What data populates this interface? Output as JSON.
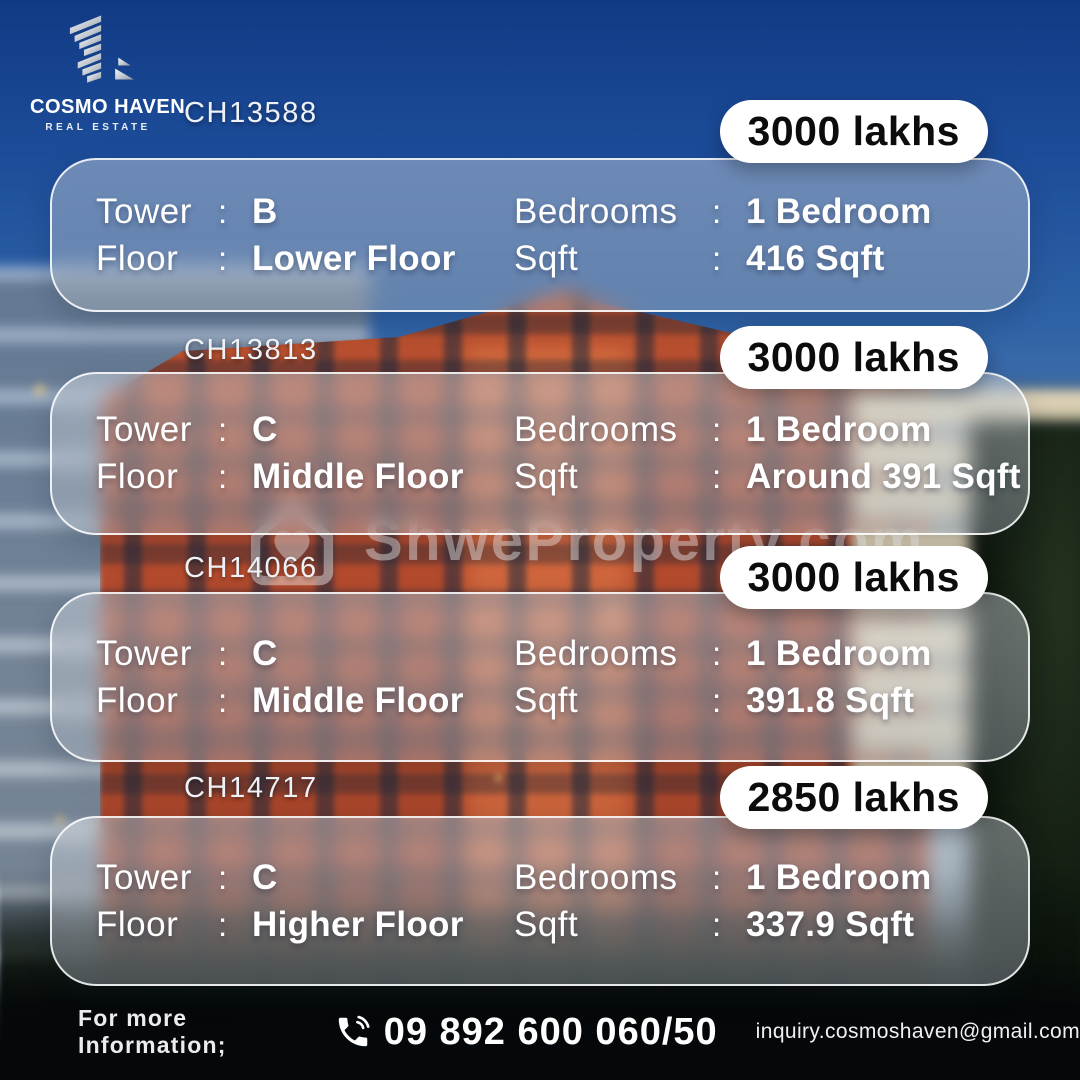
{
  "brand": {
    "name": "COSMO HAVEN",
    "tagline": "REAL ESTATE",
    "logo_icon": "building-stripes-icon"
  },
  "labels": {
    "tower": "Tower",
    "floor": "Floor",
    "bedrooms": "Bedrooms",
    "sqft": "Sqft",
    "colon": ":"
  },
  "listings": [
    {
      "code": "CH13588",
      "price": "3000 lakhs",
      "tower": "B",
      "floor": "Lower Floor",
      "bedrooms": "1 Bedroom",
      "sqft": "416 Sqft"
    },
    {
      "code": "CH13813",
      "price": "3000 lakhs",
      "tower": "C",
      "floor": "Middle Floor",
      "bedrooms": "1 Bedroom",
      "sqft": "Around 391 Sqft"
    },
    {
      "code": "CH14066",
      "price": "3000 lakhs",
      "tower": "C",
      "floor": "Middle Floor",
      "bedrooms": "1 Bedroom",
      "sqft": "391.8 Sqft"
    },
    {
      "code": "CH14717",
      "price": "2850 lakhs",
      "tower": "C",
      "floor": "Higher Floor",
      "bedrooms": "1 Bedroom",
      "sqft": "337.9 Sqft"
    }
  ],
  "watermark": {
    "text": "ShweProperty.com",
    "icon": "house-heart-icon"
  },
  "footer": {
    "info_label": "For more Information;",
    "phone": "09 892 600 060/50",
    "email": "inquiry.cosmoshaven@gmail.com",
    "phone_icon": "phone-icon"
  },
  "colors": {
    "sky_blue": "#1c4c99",
    "building_orange": "#b34a2d",
    "badge_bg": "#ffffff",
    "badge_text": "#0c0c0c",
    "card_border": "#ffffff",
    "text_white": "#ffffff",
    "footer_bg": "#05080a"
  }
}
